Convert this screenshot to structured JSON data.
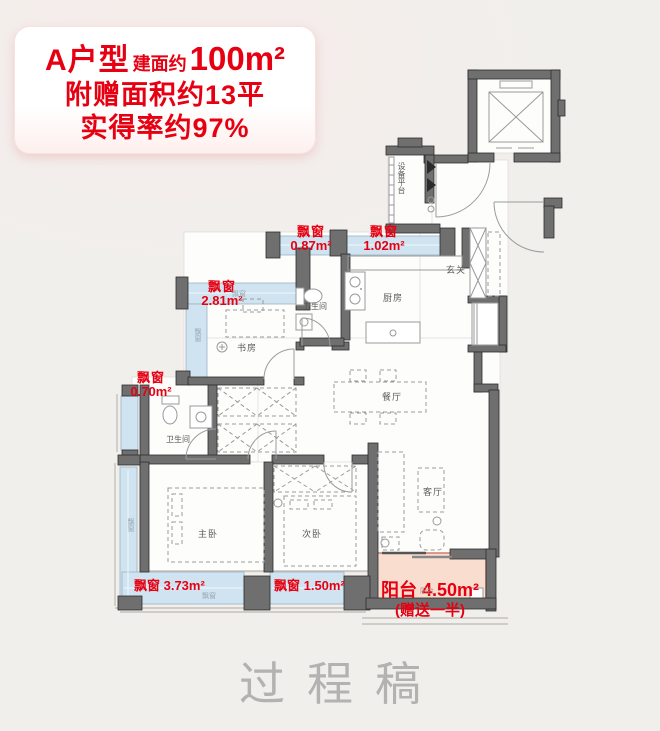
{
  "card": {
    "type": "A户型",
    "area_prefix": "建面约",
    "area": "100m²",
    "bonus_line": "附赠面积约13平",
    "rate_line": "实得率约97%"
  },
  "rooms": {
    "entry": "玄关",
    "kitchen": "厨房",
    "bath1": "卫生间",
    "study": "书房",
    "dining": "餐厅",
    "living": "客厅",
    "master": "主卧",
    "second": "次卧",
    "bath2": "卫生间",
    "equipment": "设备平台"
  },
  "bays": {
    "b087": {
      "name": "飘窗",
      "area": "0.87m²"
    },
    "b102": {
      "name": "飘窗",
      "area": "1.02m²"
    },
    "b281": {
      "name": "飘窗",
      "area": "2.81m²"
    },
    "b070": {
      "name": "飘窗",
      "area": "0.70m²"
    },
    "b373": {
      "line": "飘窗 3.73m²"
    },
    "b150": {
      "line": "飘窗 1.50m²"
    }
  },
  "balcony": {
    "title": "阳台 4.50m²",
    "note": "(赠送一半)"
  },
  "tags": {
    "bay": "飘窗",
    "balcony": "阳台"
  },
  "watermark": "过程稿",
  "colors": {
    "accent": "#e60012",
    "bay": "#cfe3f0",
    "bay_border": "#9db2c2",
    "balcony_fill": "#f9ded0",
    "balcony_border": "#cd7e68",
    "wall": "#6f6f6f",
    "bg": "#f1efec",
    "floor": "#fdfdfc",
    "ink": "#5a5a5a"
  }
}
